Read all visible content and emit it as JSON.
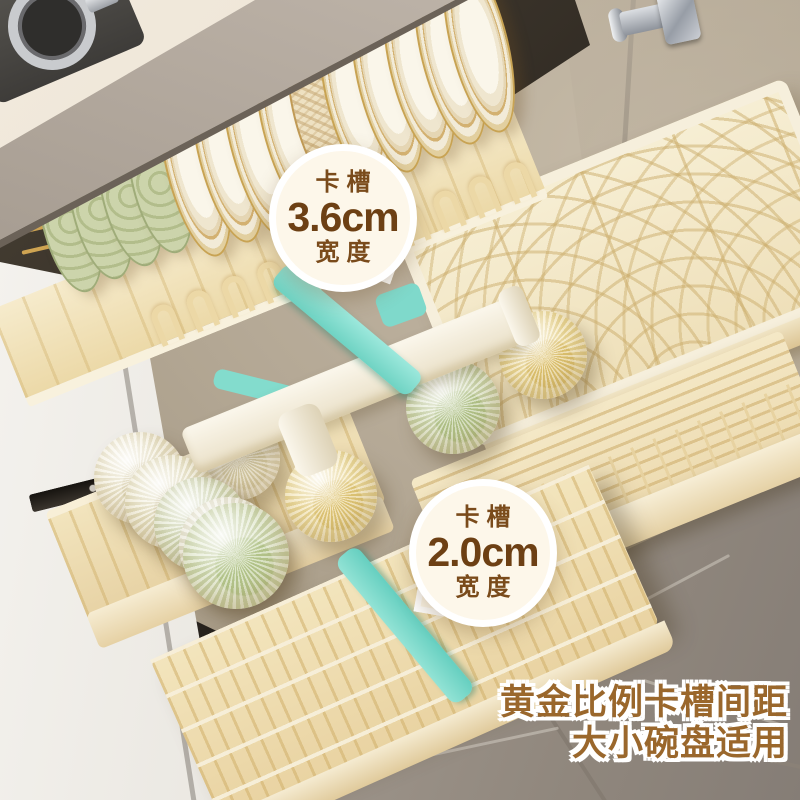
{
  "annotations": {
    "badge_large_slot": {
      "label_top": "卡槽",
      "value": "3.6cm",
      "label_bottom": "宽度"
    },
    "badge_small_slot": {
      "label_top": "卡槽",
      "value": "2.0cm",
      "label_bottom": "宽度"
    },
    "caption": {
      "line1": "黄金比例卡槽间距",
      "line2": "大小碗盘适用"
    }
  },
  "palette": {
    "badge_text": "#6d4014",
    "caption_text": "#9a672c",
    "teal_accent": "#7fdccd",
    "rack_cream": "#f3e5bf",
    "counter_gray": "#a79d92",
    "wall_beige": "#b5a996",
    "floor_gray": "#a29890",
    "plate_gold_rim": "#c8a353"
  }
}
